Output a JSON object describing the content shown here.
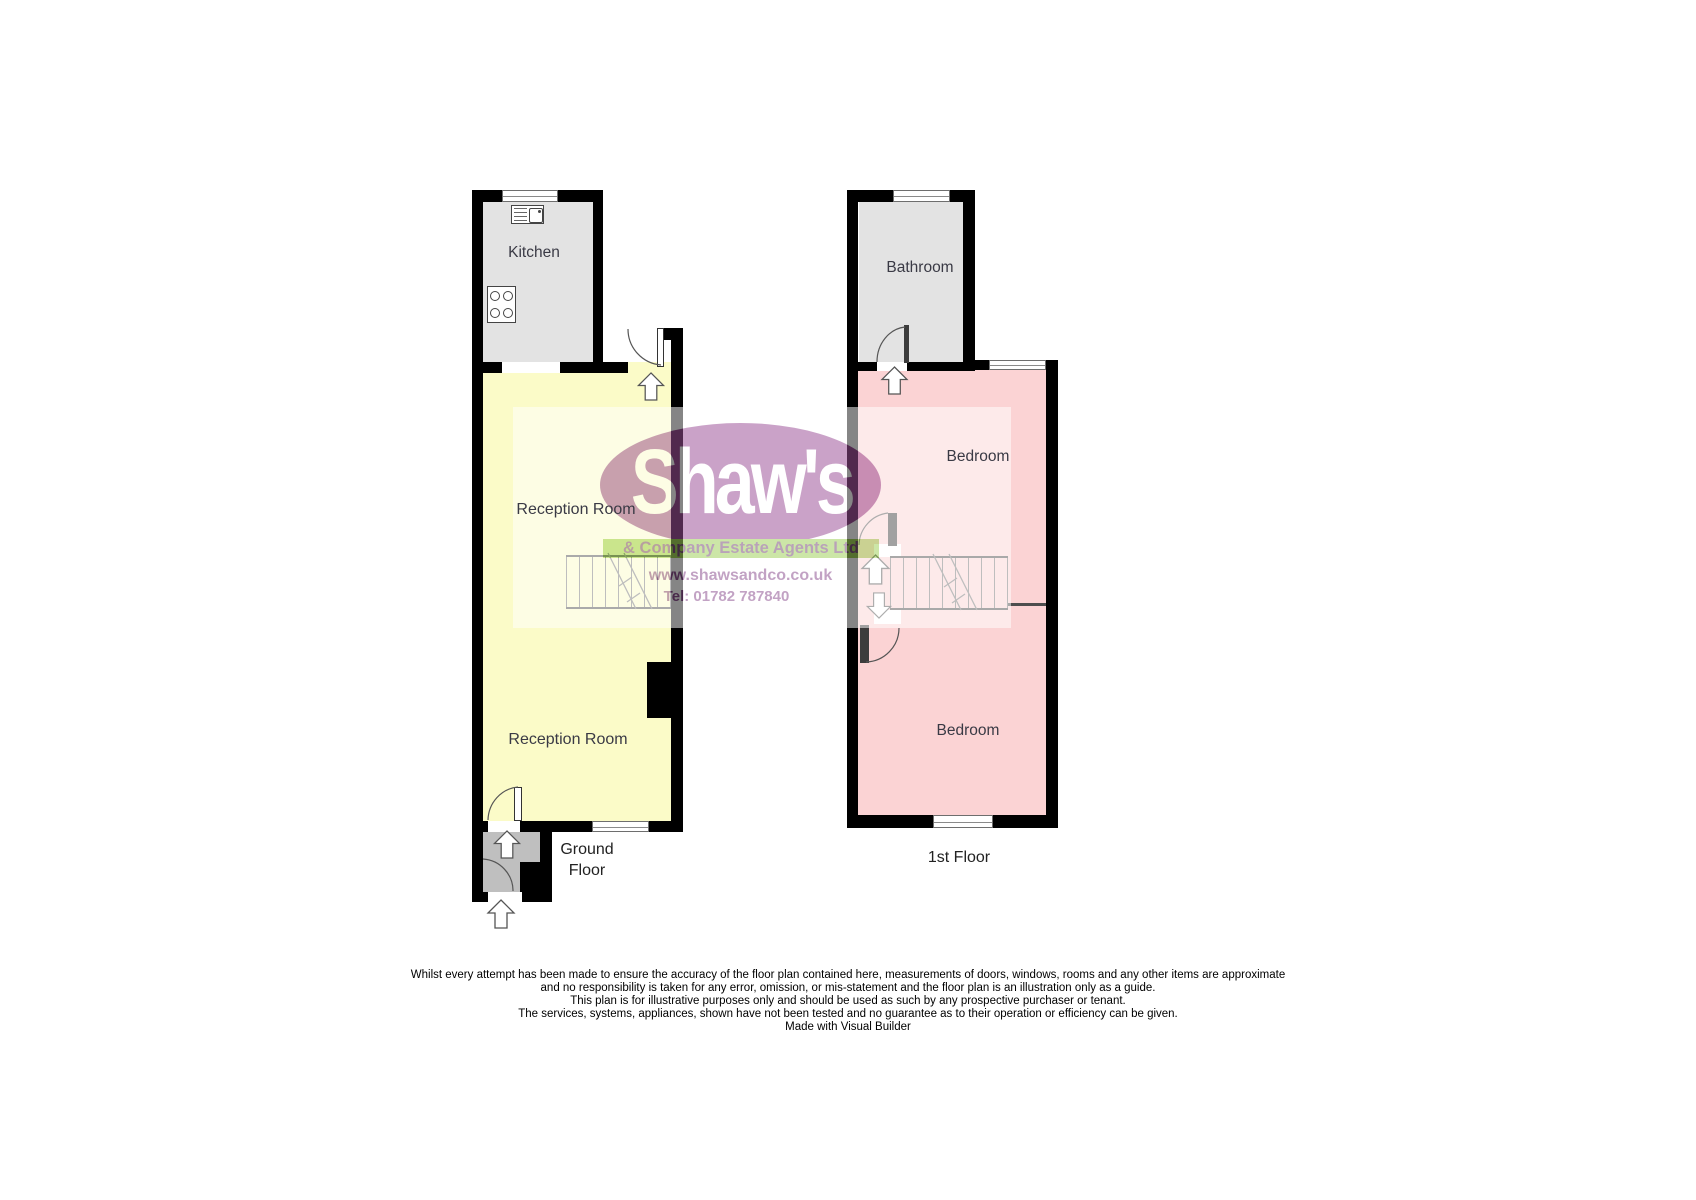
{
  "watermark": {
    "brand": "Shaw's",
    "tagline": "& Company Estate Agents Ltd",
    "website": "www.shawsandco.co.uk",
    "phone": "Tel: 01782 787840",
    "ellipse_color": "#9b4f96",
    "band_color": "#9fd157",
    "text_color": "#8b4f8f"
  },
  "ground_floor": {
    "kitchen_label": "Kitchen",
    "reception_upper_label": "Reception Room",
    "reception_lower_label": "Reception Room",
    "floor_label_line1": "Ground",
    "floor_label_line2": "Floor"
  },
  "first_floor": {
    "bathroom_label": "Bathroom",
    "bedroom_upper_label": "Bedroom",
    "bedroom_lower_label": "Bedroom",
    "floor_label": "1st Floor"
  },
  "disclaimer": {
    "lines": [
      "Whilst every attempt has been made to ensure the accuracy of the floor plan contained here, measurements of doors, windows, rooms and any other items are approximate",
      "and no responsibility is taken for any error, omission, or mis-statement and the floor plan is an illustration only as a guide.",
      "This plan is for illustrative purposes only and should be used as such by any prospective purchaser or tenant.",
      "The services, systems, appliances, shown have not been tested and no guarantee as to their operation or efficiency can be given.",
      "Made with Visual Builder"
    ]
  },
  "colors": {
    "room_yellow": "#fbfbc8",
    "room_pink": "#fbd3d4",
    "room_gray": "#e3e3e3",
    "hall_gray": "#bfbfbf",
    "wall": "#000000"
  }
}
